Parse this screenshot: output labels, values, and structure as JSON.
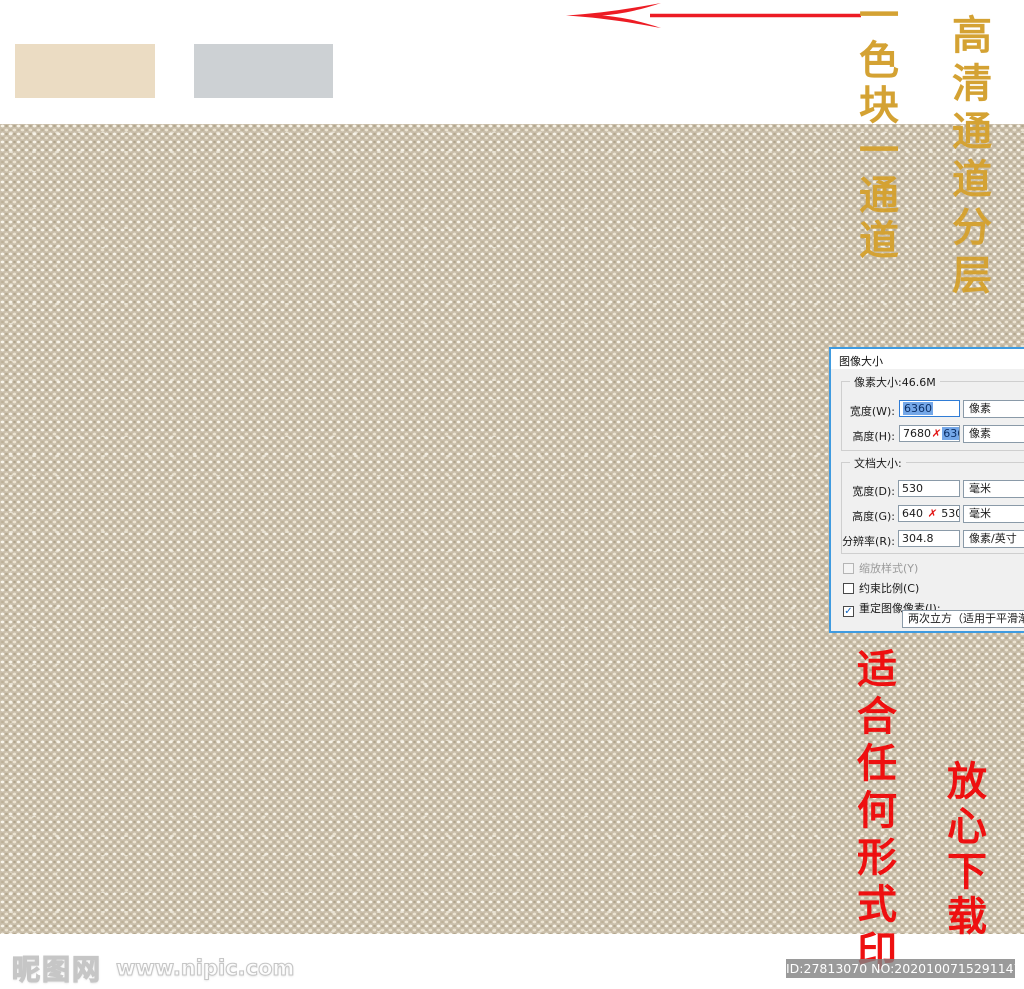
{
  "annotations": {
    "gold_right_column": "高清通道分层",
    "gold_left_column": "一色块一通道",
    "red_left_column": "适合任何形式印",
    "red_right_column": "放心下载",
    "gold_color": "#d4a233",
    "red_color": "#ee1010",
    "arrow_color": "#ed1c24"
  },
  "swatches": [
    {
      "name": "beige-swatch",
      "color": "#ebdcc3"
    },
    {
      "name": "gray-swatch",
      "color": "#cdd1d4"
    }
  ],
  "texture": {
    "base_color": "#c9beaa",
    "knot_color": "#f6f2e7"
  },
  "dialog": {
    "title": "图像大小",
    "pixel_group": {
      "legend": "像素大小:46.6M",
      "width_label": "宽度(W):",
      "width_value": "6360",
      "width_unit": "像素",
      "height_label": "高度(H):",
      "height_old": "7680",
      "strike_mark": "✗",
      "height_new": "6360",
      "height_unit": "像素"
    },
    "doc_group": {
      "legend": "文档大小:",
      "width_label": "宽度(D):",
      "width_value": "530",
      "width_unit": "毫米",
      "height_label": "高度(G):",
      "height_old": "640",
      "strike_mark": "✗",
      "height_new": "530",
      "height_unit": "毫米",
      "res_label": "分辨率(R):",
      "res_value": "304.8",
      "res_unit": "像素/英寸"
    },
    "checkboxes": [
      {
        "label": "缩放样式(Y)",
        "state": "disabled",
        "check": ""
      },
      {
        "label": "约束比例(C)",
        "state": "unchecked",
        "check": ""
      },
      {
        "label": "重定图像像素(I):",
        "state": "checked",
        "check": "✓"
      }
    ],
    "resample_method": "两次立方（适用于平滑渐变"
  },
  "footer": {
    "site_name": "昵图网",
    "site_url": "www.nipic.com",
    "id_text": "ID:27813070 NO:20201007152911478088"
  }
}
